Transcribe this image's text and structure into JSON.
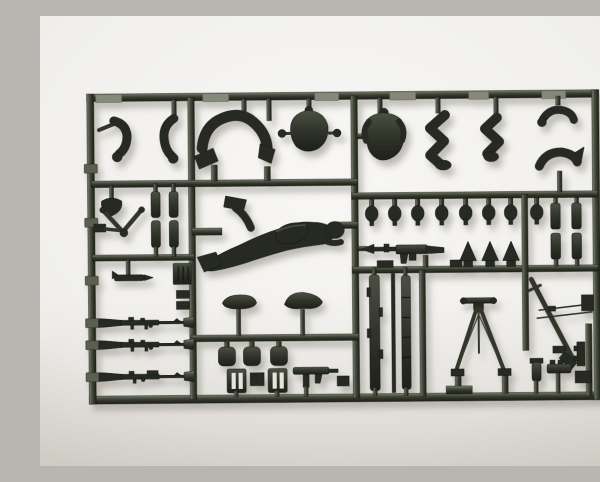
{
  "image": {
    "type": "photograph",
    "subject": "Dark grey-green injection-moulded plastic model kit sprue (parts runner) holding small soldier-figure and weapon parts",
    "background": "plain light seamless studio backdrop with soft shadow under the sprue",
    "text_visible": "none"
  },
  "colors": {
    "background_top": "#f8f7f5",
    "background_bottom": "#dbd8d1",
    "plastic_highlight": "#7e8372",
    "plastic_mid": "#4a4f42",
    "plastic_dark": "#2c3026",
    "part_dark": "#282c22",
    "shadow": "#8f897f",
    "slot": "#e7e4de"
  },
  "sprue": {
    "frame": "rectangular outer frame with horizontal and vertical internal runners dividing cells",
    "parts": [
      {
        "name": "bent-arm",
        "count": 2,
        "area": "top-left cell"
      },
      {
        "name": "crawling-legs-arch",
        "count": 1,
        "area": "top-left cell"
      },
      {
        "name": "torso-back-with-shoulder-pegs",
        "count": 1,
        "area": "top-centre cell"
      },
      {
        "name": "torso-front-with-head-stub",
        "count": 1,
        "area": "top-right cell"
      },
      {
        "name": "bent-seated-legs",
        "count": 2,
        "area": "top-right cell"
      },
      {
        "name": "reaching-arm",
        "count": 1,
        "area": "top-far-right"
      },
      {
        "name": "curved-arm",
        "count": 1,
        "area": "top-far-right"
      },
      {
        "name": "helmeted-head",
        "count": 8,
        "area": "row under middle-right runner"
      },
      {
        "name": "prone-crawling-soldier",
        "count": 1,
        "area": "centre cell"
      },
      {
        "name": "machine-gun-with-bipod",
        "count": 1,
        "area": "centre-right"
      },
      {
        "name": "ammo-cone",
        "count": 3,
        "area": "centre-right"
      },
      {
        "name": "rifle",
        "count": 3,
        "area": "lower-left column"
      },
      {
        "name": "v-brace-bipod",
        "count": 1,
        "area": "mid-left cell"
      },
      {
        "name": "equipment-cylinder",
        "count": 4,
        "area": "mid-left and far-right column"
      },
      {
        "name": "shovel-head",
        "count": 1,
        "area": "mid-left cell"
      },
      {
        "name": "magazine-box",
        "count": 1,
        "area": "mid-left cell"
      },
      {
        "name": "field-cap",
        "count": 2,
        "area": "lower-centre cell"
      },
      {
        "name": "canteen",
        "count": 3,
        "area": "lower-centre cell"
      },
      {
        "name": "slotted-grate",
        "count": 2,
        "area": "lower-centre cell"
      },
      {
        "name": "submachine-gun",
        "count": 1,
        "area": "lower-centre cell"
      },
      {
        "name": "segmented-strip",
        "count": 3,
        "area": "lower-right, left of tripod"
      },
      {
        "name": "a-frame-tripod-with-wires",
        "count": 1,
        "area": "lower-right cell"
      },
      {
        "name": "diagonal-gun-barrel",
        "count": 1,
        "area": "lower-far-right cell"
      },
      {
        "name": "cleaning-rod-wire",
        "count": 2,
        "area": "lower-far-right cell"
      },
      {
        "name": "small-box-pouch",
        "count": 9,
        "area": "various cells"
      }
    ]
  }
}
